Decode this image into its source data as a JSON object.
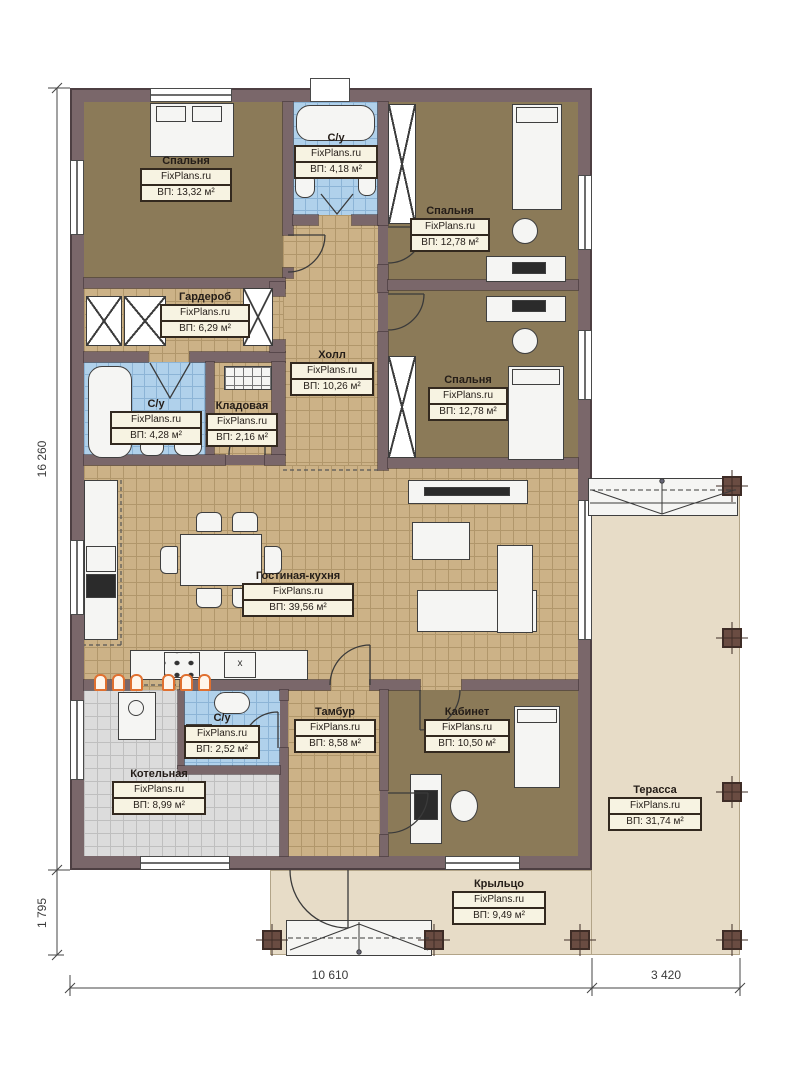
{
  "brand": "FixPlans.ru",
  "rooms": {
    "bedroom_tl": {
      "name": "Спальня",
      "area": "ВП: 13,32 м²"
    },
    "bath_top": {
      "name": "С/у",
      "area": "ВП: 4,18 м²"
    },
    "bedroom_tr": {
      "name": "Спальня",
      "area": "ВП: 12,78 м²"
    },
    "wardrobe": {
      "name": "Гардероб",
      "area": "ВП: 6,29 м²"
    },
    "hall": {
      "name": "Холл",
      "area": "ВП: 10,26 м²"
    },
    "bedroom_mr": {
      "name": "Спальня",
      "area": "ВП: 12,78 м²"
    },
    "bath_left": {
      "name": "С/у",
      "area": "ВП: 4,28 м²"
    },
    "storage": {
      "name": "Кладовая",
      "area": "ВП: 2,16 м²"
    },
    "living": {
      "name": "Гостиная-кухня",
      "area": "ВП: 39,56 м²"
    },
    "boiler": {
      "name": "Котельная",
      "area": "ВП: 8,99 м²"
    },
    "bath_small": {
      "name": "С/у",
      "area": "ВП: 2,52 м²"
    },
    "tambour": {
      "name": "Тамбур",
      "area": "ВП: 8,58 м²"
    },
    "office": {
      "name": "Кабинет",
      "area": "ВП: 10,50 м²"
    },
    "terrace": {
      "name": "Терасса",
      "area": "ВП: 31,74 м²"
    },
    "porch": {
      "name": "Крыльцо",
      "area": "ВП: 9,49 м²"
    }
  },
  "dimensions": {
    "height_total": "16 260",
    "porch_depth": "1 795",
    "width_house": "10 610",
    "width_terrace": "3 420"
  },
  "living_extras": {
    "appliance_label": "x"
  },
  "colors": {
    "wall": "#7a676a",
    "bedroom_floor": "#8b7a58",
    "tile_tan": "#ccb287",
    "tile_blue": "#b0d1eb",
    "tile_gray": "#dcdcdc",
    "terrace_floor": "#e7dcc7",
    "heating_accent": "#e07030"
  }
}
